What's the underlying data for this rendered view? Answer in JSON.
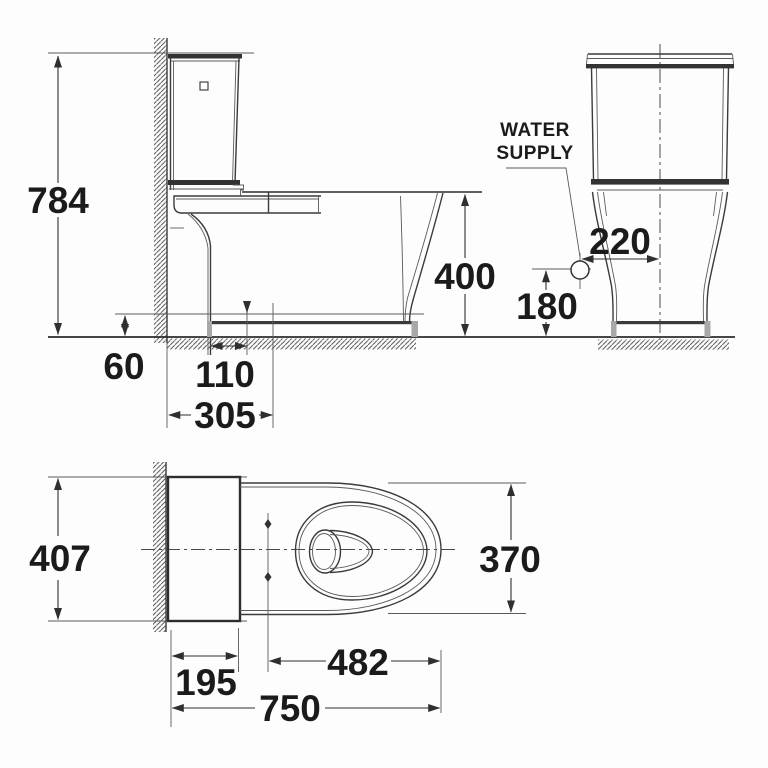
{
  "drawing": {
    "type": "technical-dimension-drawing",
    "subject": "two-piece toilet",
    "units": "mm",
    "views": [
      {
        "id": "side-elevation",
        "dimensions_mm": [
          784,
          400,
          60,
          110,
          305
        ]
      },
      {
        "id": "front-elevation",
        "annotation": "WATER SUPPLY",
        "dimensions_mm": [
          220,
          180
        ]
      },
      {
        "id": "plan",
        "dimensions_mm": [
          407,
          370,
          195,
          482,
          750
        ]
      }
    ]
  },
  "labels": {
    "d784": "784",
    "d400": "400",
    "d60": "60",
    "d110": "110",
    "d305": "305",
    "d220": "220",
    "d180": "180",
    "d407": "407",
    "d370": "370",
    "d195": "195",
    "d482": "482",
    "d750": "750",
    "water_supply_1": "WATER",
    "water_supply_2": "SUPPLY"
  },
  "colors": {
    "background": "#fdfdfd",
    "line": "#3b3b3b",
    "text": "#1b1b1b",
    "fill_dark": "#333333",
    "fill_gray": "#a8a8a8",
    "hatch": "#4a4a4a"
  }
}
